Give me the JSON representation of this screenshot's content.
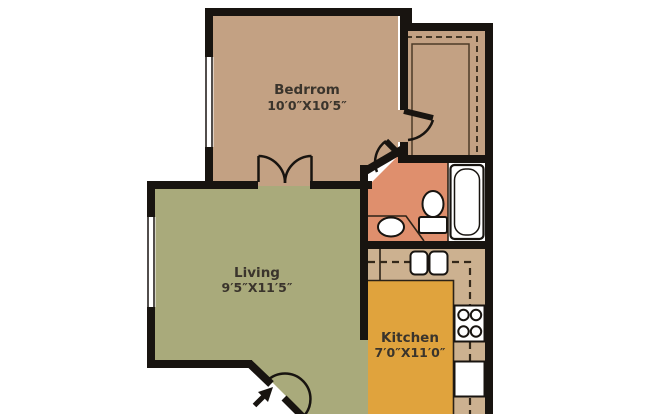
{
  "floorplan": {
    "rooms": {
      "bedroom": {
        "label": "Bedrrom",
        "dimensions": "10′0″X10′5″"
      },
      "living": {
        "label": "Living",
        "dimensions": "9′5″X11′5″"
      },
      "kitchen": {
        "label": "Kitchen",
        "dimensions": "7′0″X11′0″"
      }
    },
    "unlabeled_areas": [
      "bathroom",
      "closet"
    ],
    "fixtures": [
      "bathtub",
      "toilet",
      "bathroom-sink",
      "kitchen-double-sink",
      "stove-burners",
      "refrigerator",
      "closet-shelves",
      "upper-cabinet-dashed-line",
      "entry-arrow",
      "bedroom-window",
      "living-window",
      "double-door",
      "bedroom-door",
      "bathroom-door",
      "entry-door"
    ],
    "colors": {
      "bedroom": "#c3a183",
      "closet": "#c3a183",
      "living": "#a9aa7b",
      "kitchen": "#e0a33d",
      "bathroom": "#df8f6d",
      "counter": "#ccb190",
      "wall": "#181410",
      "fixture_fill": "#ffffff",
      "fixture_outline": "#181410",
      "label_text": "#3a342c",
      "background": "#ffffff",
      "cabinet_dash": "#33281a",
      "shelf_line": "#4c3b28",
      "counter_edge": "#2b2217"
    }
  }
}
